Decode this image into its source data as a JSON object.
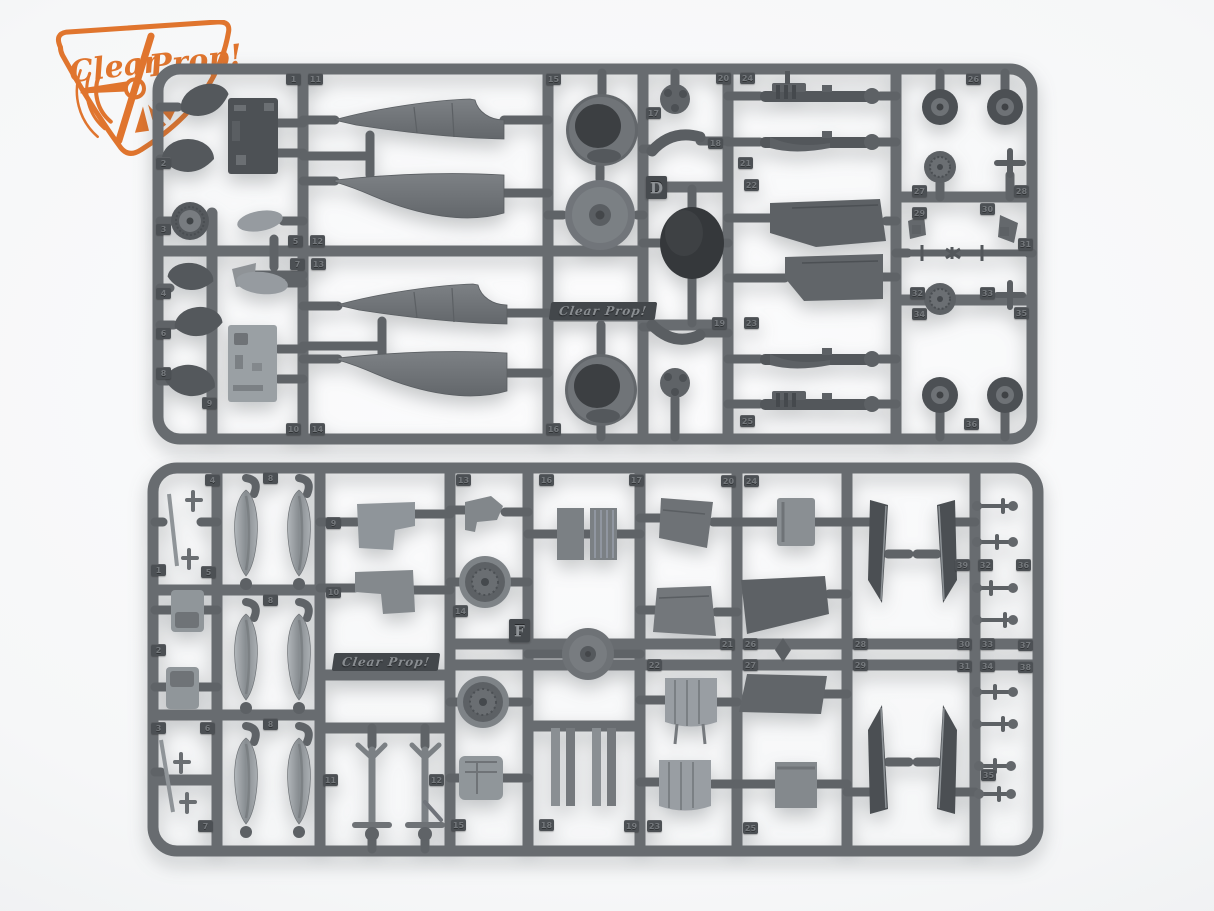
{
  "photo": {
    "description": "Product photo of two dark grey injection-moulded plastic model kit sprues (frames D and F) with aircraft parts, on a light studio background",
    "background_color": "#f6f7f8"
  },
  "brand_logo": {
    "word1": "Clear",
    "word2": "Prop!",
    "color": "#e0752e"
  },
  "palette": {
    "rail": "#686c70",
    "stub": "#5f6367",
    "part_dark": "#4d5155",
    "part_mid": "#73777b",
    "part_light": "#9aa0a4",
    "tire": "#35383b",
    "tag_bg": "#4c5054",
    "tag_text": "#74787c"
  },
  "sprue_top": {
    "letter": "D",
    "embossed_text": "Clear Prop!",
    "tags": [
      {
        "n": "1",
        "x": 134,
        "y": 10
      },
      {
        "n": "11",
        "x": 156,
        "y": 10
      },
      {
        "n": "15",
        "x": 394,
        "y": 10
      },
      {
        "n": "20",
        "x": 564,
        "y": 9
      },
      {
        "n": "24",
        "x": 588,
        "y": 9
      },
      {
        "n": "26",
        "x": 814,
        "y": 10
      },
      {
        "n": "2",
        "x": 4,
        "y": 94
      },
      {
        "n": "3",
        "x": 4,
        "y": 160
      },
      {
        "n": "4",
        "x": 4,
        "y": 224
      },
      {
        "n": "6",
        "x": 4,
        "y": 264
      },
      {
        "n": "8",
        "x": 4,
        "y": 304
      },
      {
        "n": "9",
        "x": 50,
        "y": 334
      },
      {
        "n": "5",
        "x": 136,
        "y": 172
      },
      {
        "n": "7",
        "x": 138,
        "y": 195
      },
      {
        "n": "12",
        "x": 158,
        "y": 172
      },
      {
        "n": "13",
        "x": 159,
        "y": 195
      },
      {
        "n": "10",
        "x": 134,
        "y": 360
      },
      {
        "n": "14",
        "x": 158,
        "y": 360
      },
      {
        "n": "16",
        "x": 394,
        "y": 360
      },
      {
        "n": "17",
        "x": 494,
        "y": 44
      },
      {
        "n": "18",
        "x": 556,
        "y": 74
      },
      {
        "n": "19",
        "x": 560,
        "y": 254
      },
      {
        "n": "21",
        "x": 586,
        "y": 94
      },
      {
        "n": "22",
        "x": 592,
        "y": 116
      },
      {
        "n": "23",
        "x": 592,
        "y": 254
      },
      {
        "n": "25",
        "x": 588,
        "y": 352
      },
      {
        "n": "27",
        "x": 760,
        "y": 122
      },
      {
        "n": "28",
        "x": 862,
        "y": 122
      },
      {
        "n": "29",
        "x": 760,
        "y": 144
      },
      {
        "n": "30",
        "x": 828,
        "y": 140
      },
      {
        "n": "31",
        "x": 866,
        "y": 175
      },
      {
        "n": "32",
        "x": 758,
        "y": 224
      },
      {
        "n": "33",
        "x": 828,
        "y": 224
      },
      {
        "n": "34",
        "x": 760,
        "y": 245
      },
      {
        "n": "35",
        "x": 862,
        "y": 244
      },
      {
        "n": "36",
        "x": 812,
        "y": 355
      }
    ]
  },
  "sprue_bottom": {
    "letter": "F",
    "embossed_text": "Clear Prop!",
    "tags": [
      {
        "n": "4",
        "x": 58,
        "y": 12
      },
      {
        "n": "8",
        "x": 116,
        "y": 10
      },
      {
        "n": "13",
        "x": 309,
        "y": 12
      },
      {
        "n": "16",
        "x": 392,
        "y": 12
      },
      {
        "n": "17",
        "x": 482,
        "y": 12
      },
      {
        "n": "20",
        "x": 574,
        "y": 13
      },
      {
        "n": "24",
        "x": 597,
        "y": 13
      },
      {
        "n": "1",
        "x": 4,
        "y": 102
      },
      {
        "n": "5",
        "x": 54,
        "y": 104
      },
      {
        "n": "8",
        "x": 116,
        "y": 132
      },
      {
        "n": "2",
        "x": 4,
        "y": 182
      },
      {
        "n": "9",
        "x": 179,
        "y": 55
      },
      {
        "n": "10",
        "x": 179,
        "y": 124
      },
      {
        "n": "3",
        "x": 4,
        "y": 260
      },
      {
        "n": "6",
        "x": 53,
        "y": 260
      },
      {
        "n": "8",
        "x": 116,
        "y": 256
      },
      {
        "n": "7",
        "x": 51,
        "y": 358
      },
      {
        "n": "11",
        "x": 176,
        "y": 312
      },
      {
        "n": "12",
        "x": 282,
        "y": 312
      },
      {
        "n": "14",
        "x": 306,
        "y": 143
      },
      {
        "n": "15",
        "x": 304,
        "y": 357
      },
      {
        "n": "18",
        "x": 392,
        "y": 357
      },
      {
        "n": "19",
        "x": 477,
        "y": 358
      },
      {
        "n": "23",
        "x": 500,
        "y": 358
      },
      {
        "n": "25",
        "x": 596,
        "y": 360
      },
      {
        "n": "21",
        "x": 573,
        "y": 176
      },
      {
        "n": "22",
        "x": 500,
        "y": 197
      },
      {
        "n": "26",
        "x": 596,
        "y": 176
      },
      {
        "n": "27",
        "x": 596,
        "y": 197
      },
      {
        "n": "28",
        "x": 706,
        "y": 176
      },
      {
        "n": "29",
        "x": 706,
        "y": 197
      },
      {
        "n": "30",
        "x": 810,
        "y": 176
      },
      {
        "n": "31",
        "x": 810,
        "y": 198
      },
      {
        "n": "33",
        "x": 833,
        "y": 176
      },
      {
        "n": "34",
        "x": 833,
        "y": 198
      },
      {
        "n": "37",
        "x": 871,
        "y": 177
      },
      {
        "n": "38",
        "x": 871,
        "y": 199
      },
      {
        "n": "32",
        "x": 831,
        "y": 97
      },
      {
        "n": "36",
        "x": 869,
        "y": 97
      },
      {
        "n": "39",
        "x": 808,
        "y": 97
      },
      {
        "n": "35",
        "x": 834,
        "y": 307
      }
    ]
  }
}
